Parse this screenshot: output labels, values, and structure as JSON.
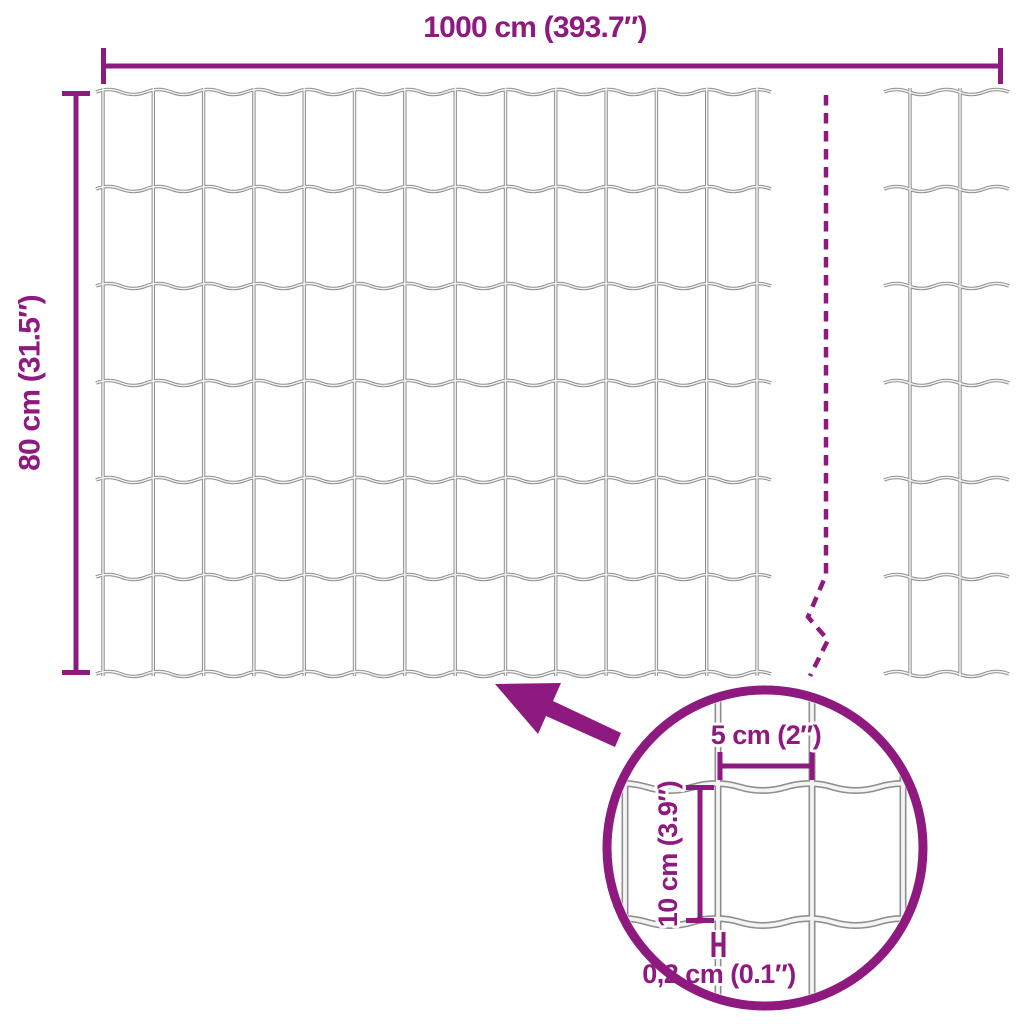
{
  "colors": {
    "accent": "#8e1a80",
    "wire": "#8f8f8f",
    "wire_core": "#f4f4f4",
    "background": "#ffffff"
  },
  "diagram": {
    "overall_width_label": "1000 cm (393.7″)",
    "overall_height_label": "80 cm (31.5″)",
    "detail": {
      "cell_width_label": "5 cm (2″)",
      "cell_height_label": "10 cm (3.9″)",
      "wire_thickness_label": "0,2 cm (0.1″)"
    }
  }
}
